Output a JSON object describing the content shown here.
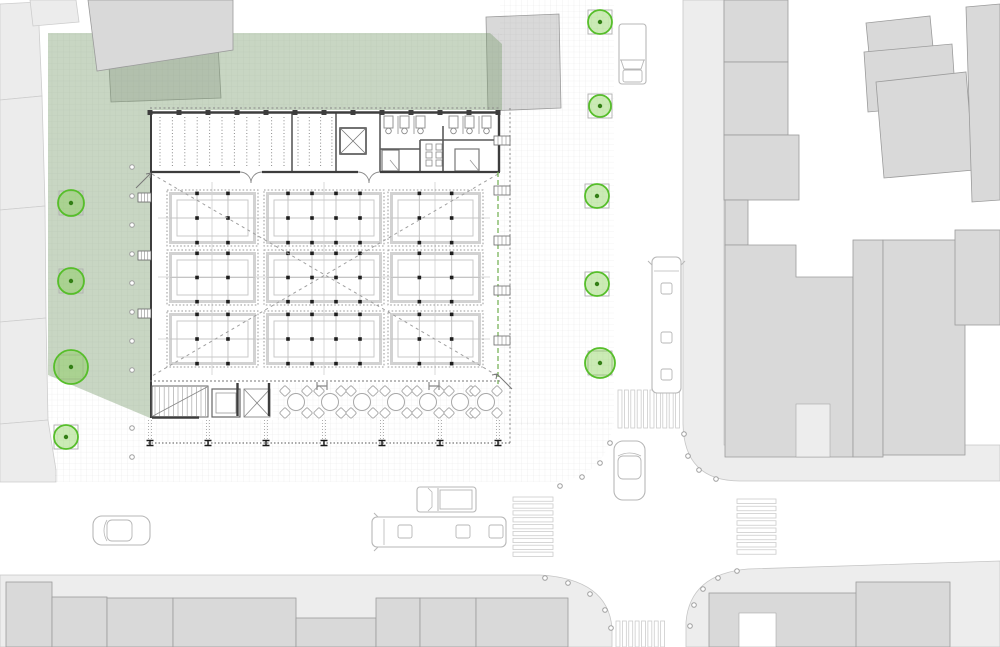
{
  "scene": {
    "width": 1000,
    "height": 647,
    "colors": {
      "bg": "#ffffff",
      "parcel_fill": "#ececec",
      "parcel_stroke": "#cdcdcd",
      "building_fill": "#d9d9d9",
      "building_stroke": "#9b9b9b",
      "sidewalk_fill": "#ededed",
      "sidewalk_stroke": "#c6c6c6",
      "grid_line": "rgba(110,110,110,0.16)",
      "green_fill": "rgba(124,158,112,0.42)",
      "tree_stroke": "#56be2a",
      "tree_fill": "rgba(126,205,70,0.40)",
      "tree_dot": "#337f15",
      "planter_stroke": "#b0b0b0",
      "wall": "#3d3d3d",
      "partition": "#5a5a5a",
      "fixture": "#8a8a8a",
      "stall_dotted": "#9a9a9a",
      "stall_frame": "#d2d2d2",
      "stall_frame2": "#c9c9c9",
      "stall_dot": "#1e1e1e",
      "connector": "#d8d8d8",
      "diagonal": "#9f9f9f",
      "vehicle": "#b7b7b7",
      "crosswalk": "#cccccc",
      "bollard": "#9f9f9f",
      "column": "#1a1a1a",
      "green_line": "#6fae4e",
      "table": "#a8a8a8"
    },
    "parcels": [
      {
        "pts": "0,4 38,2 42,96 0,100"
      },
      {
        "pts": "0,100 42,96 45,206 0,210"
      },
      {
        "pts": "0,210 45,206 46,318 0,322"
      },
      {
        "pts": "0,322 46,318 48,420 0,424"
      },
      {
        "pts": "0,424 48,420 56,470 56,482 0,482"
      },
      {
        "pts": "30,0 76,0 79,22 33,26"
      }
    ],
    "buildings_under_green": [
      {
        "pts": "107,29 217,26 221,98 111,102"
      },
      {
        "pts": "486,17 559,14 561,108 488,111"
      }
    ],
    "buildings_over_green": [
      {
        "pts": "88,0 233,0 233,50 97,71"
      }
    ],
    "sidewalks": [
      {
        "d": "M0,575 L540,575 Q608,579 612,628 L612,647 L0,647 Z"
      },
      {
        "d": "M686,647 L686,622 Q690,574 748,569 L1000,561 L1000,647 Z"
      },
      {
        "d": "M683,0 L724,0 L724,445 L1000,445 L1000,481 L740,481 Q684,481 683,424 Z"
      }
    ],
    "district_buildings": [
      {
        "kind": "rect",
        "x": 724,
        "y": 0,
        "w": 64,
        "h": 62
      },
      {
        "kind": "rect",
        "x": 724,
        "y": 62,
        "w": 64,
        "h": 73
      },
      {
        "kind": "rect",
        "x": 724,
        "y": 135,
        "w": 75,
        "h": 65
      },
      {
        "kind": "rect",
        "x": 725,
        "y": 200,
        "w": 23,
        "h": 45
      },
      {
        "kind": "poly",
        "pts": "725,245 796,245 796,277 853,277 853,457 725,457"
      },
      {
        "kind": "rect",
        "x": 853,
        "y": 240,
        "w": 30,
        "h": 217
      },
      {
        "kind": "rect",
        "x": 883,
        "y": 240,
        "w": 82,
        "h": 215
      },
      {
        "kind": "rect",
        "x": 955,
        "y": 230,
        "w": 45,
        "h": 95
      },
      {
        "kind": "poly",
        "pts": "866,23 930,16 934,58 870,64"
      },
      {
        "kind": "poly",
        "pts": "864,52 952,44 956,104 868,112"
      },
      {
        "kind": "poly",
        "pts": "876,82 966,72 974,170 884,178"
      },
      {
        "kind": "poly",
        "pts": "966,7 1000,4 1000,200 972,202"
      },
      {
        "kind": "rect",
        "x": 6,
        "y": 582,
        "w": 46,
        "h": 65
      },
      {
        "kind": "rect",
        "x": 52,
        "y": 597,
        "w": 55,
        "h": 50
      },
      {
        "kind": "rect",
        "x": 107,
        "y": 598,
        "w": 66,
        "h": 49
      },
      {
        "kind": "rect",
        "x": 173,
        "y": 598,
        "w": 123,
        "h": 49
      },
      {
        "kind": "rect",
        "x": 296,
        "y": 618,
        "w": 80,
        "h": 29
      },
      {
        "kind": "rect",
        "x": 376,
        "y": 598,
        "w": 44,
        "h": 49
      },
      {
        "kind": "rect",
        "x": 420,
        "y": 598,
        "w": 56,
        "h": 49
      },
      {
        "kind": "rect",
        "x": 476,
        "y": 598,
        "w": 92,
        "h": 49
      },
      {
        "kind": "rect",
        "x": 709,
        "y": 593,
        "w": 196,
        "h": 54
      },
      {
        "kind": "rect",
        "x": 856,
        "y": 582,
        "w": 94,
        "h": 65
      }
    ],
    "alley_cut": {
      "x": 796,
      "y": 404,
      "w": 34,
      "h": 53
    },
    "courtyard_cut": {
      "x": 739,
      "y": 613,
      "w": 37,
      "h": 34
    },
    "grid_regions": [
      {
        "d": "M48,33 H502 V110 H150 V420 H48 Z"
      },
      {
        "d": "M55,418 H612 V425 Q610,472 560,482 L55,482 Z"
      },
      {
        "d": "M500,0 H614 V425 H500 Z"
      },
      {
        "d": "M273,383 H500 V420 H273 Z"
      }
    ],
    "green_area": {
      "pts": "48,33 490,33 502,44 502,110 150,110 150,418 48,375"
    },
    "hall": {
      "white_shapes": [
        {
          "x": 150,
          "y": 110,
          "w": 350,
          "h": 273
        },
        {
          "x": 150,
          "y": 383,
          "w": 123,
          "h": 37
        }
      ],
      "north_wall_y": 112.5,
      "west_wall_x": 151,
      "east_wall_x": 499,
      "strip_wall_y": 172,
      "strip_wall_segments": [
        [
          150,
          240
        ],
        [
          262,
          358
        ],
        [
          380,
          500
        ]
      ],
      "door_arc_pairs": [
        [
          240,
          262
        ],
        [
          358,
          380
        ]
      ],
      "partitions": [
        "M292,113 V172",
        "M336,113 V172",
        "M380,113 V172",
        "M443,126 V172",
        "M420,140 H499",
        "M380,149 H420",
        "M420,140 V172"
      ],
      "bike_racks": [
        {
          "x0": 160,
          "step": 12.4,
          "count": 11,
          "y0": 117,
          "y1": 167
        },
        {
          "x0": 298,
          "step": 11.3,
          "count": 4,
          "y0": 117,
          "y1": 167
        }
      ],
      "elevator_top": {
        "x": 340,
        "y": 128,
        "w": 26,
        "h": 26
      },
      "toilets": {
        "xs": [
          384,
          400,
          416,
          449,
          465,
          482
        ],
        "y": 116,
        "w": 9,
        "h": 12
      },
      "stall_walls": [
        "M398,116 V134",
        "M414,116 V134",
        "M463,116 V134",
        "M479,116 V134"
      ],
      "wc_rooms": [
        {
          "x": 382,
          "y": 150,
          "w": 17,
          "h": 21
        },
        {
          "x": 455,
          "y": 149,
          "w": 24,
          "h": 22
        }
      ],
      "sinks": {
        "xs": [
          426,
          436
        ],
        "ys": [
          144,
          152,
          160
        ],
        "s": 6
      },
      "ticks_step": 29,
      "diagonals": [
        [
          152,
          174,
          498,
          376
        ],
        [
          498,
          174,
          152,
          376
        ]
      ],
      "connectors_h": {
        "ys": [
          218,
          277,
          339
        ],
        "x0": 158,
        "x1": 490
      },
      "connectors_v": {
        "xs": [
          212,
          324,
          435
        ],
        "y0": 182,
        "y1": 375
      },
      "green_edge": {
        "x": 498,
        "y0": 172,
        "y1": 384
      },
      "awning_top": {
        "y": 108,
        "x0": 150,
        "x1": 500
      },
      "awning_east": {
        "x": 510,
        "y0": 108,
        "y1": 443
      },
      "facade_glyphs_east": {
        "x": 494,
        "w": 16,
        "ys": [
          136,
          186,
          236,
          286,
          336
        ]
      },
      "facade_glyphs_west": {
        "x": 138,
        "w": 13,
        "ys": [
          193,
          251,
          309
        ]
      },
      "arrows": [
        [
          136,
          188,
          151,
          173
        ],
        [
          512,
          389,
          497,
          374
        ]
      ]
    },
    "stalls": {
      "cols": [
        {
          "x": 167,
          "w": 91,
          "fx": [
            0.33,
            0.67
          ]
        },
        {
          "x": 264,
          "w": 120,
          "fx": [
            0.2,
            0.4,
            0.6,
            0.8
          ]
        },
        {
          "x": 388,
          "w": 95,
          "fx": [
            0.33,
            0.67
          ]
        }
      ],
      "rows": [
        {
          "y": 190,
          "h": 56
        },
        {
          "y": 250,
          "h": 55
        },
        {
          "y": 311,
          "h": 56
        }
      ],
      "fy": [
        0.06,
        0.5,
        0.94
      ]
    },
    "south_strip": {
      "dashed_top_y": 381,
      "stair": {
        "x": 152,
        "y": 386,
        "w": 56,
        "h": 31
      },
      "elevator": {
        "x": 212,
        "y": 389,
        "w": 28,
        "h": 28
      },
      "escalator": {
        "x": 244,
        "y": 389,
        "w": 26,
        "h": 28
      },
      "dark_walls": [
        "M152,417.5 H199",
        "M237.5,383 V416",
        "M269,383 V416"
      ],
      "tables": {
        "xs": [
          296,
          330,
          362,
          396,
          428,
          460,
          486
        ],
        "y": 402,
        "r": 8.5
      },
      "posts": [
        [
          322,
          386
        ],
        [
          434,
          386
        ]
      ],
      "colonnade": {
        "y": 443,
        "x0": 148,
        "x1": 512,
        "xs": [
          150,
          208,
          266,
          324,
          382,
          440,
          498
        ]
      }
    },
    "trees": [
      {
        "x": 71,
        "y": 203,
        "r": 13
      },
      {
        "x": 71,
        "y": 281,
        "r": 13
      },
      {
        "x": 71,
        "y": 367,
        "r": 17
      },
      {
        "x": 66,
        "y": 437,
        "r": 12
      },
      {
        "x": 600,
        "y": 22,
        "r": 12
      },
      {
        "x": 600,
        "y": 106,
        "r": 11
      },
      {
        "x": 597,
        "y": 196,
        "r": 12
      },
      {
        "x": 597,
        "y": 284,
        "r": 12
      },
      {
        "x": 600,
        "y": 363,
        "r": 15
      }
    ],
    "bollards": [
      [
        132,
        167
      ],
      [
        132,
        196
      ],
      [
        132,
        225
      ],
      [
        132,
        254
      ],
      [
        132,
        283
      ],
      [
        132,
        312
      ],
      [
        132,
        341
      ],
      [
        132,
        370
      ],
      [
        132,
        428
      ],
      [
        132,
        457
      ],
      [
        560,
        486
      ],
      [
        582,
        477
      ],
      [
        600,
        463
      ],
      [
        610,
        443
      ],
      [
        684,
        434
      ],
      [
        688,
        456
      ],
      [
        699,
        470
      ],
      [
        716,
        479
      ],
      [
        690,
        626
      ],
      [
        694,
        605
      ],
      [
        703,
        589
      ],
      [
        718,
        578
      ],
      [
        737,
        571
      ],
      [
        545,
        578
      ],
      [
        568,
        583
      ],
      [
        590,
        594
      ],
      [
        605,
        610
      ],
      [
        611,
        628
      ]
    ],
    "crosswalks": [
      {
        "x": 618,
        "y": 390,
        "w": 64,
        "h": 38,
        "dir": "v",
        "count": 10
      },
      {
        "x": 513,
        "y": 497,
        "w": 40,
        "h": 62,
        "dir": "h",
        "count": 9
      },
      {
        "x": 737,
        "y": 499,
        "w": 39,
        "h": 58,
        "dir": "h",
        "count": 8
      },
      {
        "x": 616,
        "y": 621,
        "w": 51,
        "h": 26,
        "dir": "v",
        "count": 8
      }
    ],
    "vehicles": [
      {
        "type": "van_v",
        "x": 619,
        "y": 24,
        "w": 27,
        "h": 60
      },
      {
        "type": "bus_v",
        "x": 652,
        "y": 257,
        "w": 29,
        "h": 136
      },
      {
        "type": "car_v",
        "x": 614,
        "y": 441,
        "w": 31,
        "h": 59
      },
      {
        "type": "car_h",
        "x": 93,
        "y": 516,
        "w": 57,
        "h": 29
      },
      {
        "type": "pickup_h",
        "x": 417,
        "y": 487,
        "w": 59,
        "h": 25
      },
      {
        "type": "bus_h",
        "x": 372,
        "y": 517,
        "w": 134,
        "h": 30
      }
    ]
  }
}
